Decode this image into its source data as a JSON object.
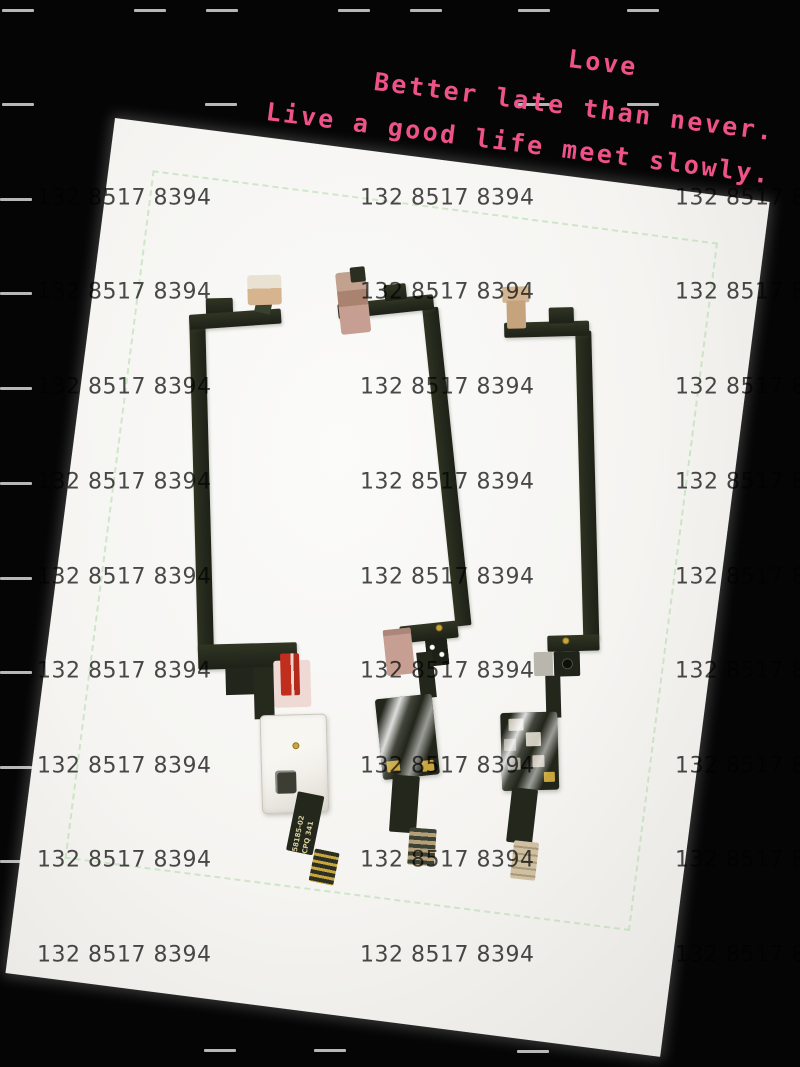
{
  "palette": {
    "background": "#050505",
    "dash": "#cbcbcb",
    "photo_paper": "#f5f4f1",
    "photo_shade": "#e6e5e1",
    "crop_mark_green": "#a8d8a0",
    "watermark_gray": "#3b3b3b",
    "quote_pink": "#ee5288",
    "cable_dark": "#262a1e",
    "connector_tan": "#d6b48e",
    "connector_pink": "#c79e92",
    "pull_tab_red": "#c22e1d",
    "tape_pink": "#eed9d4",
    "shield_white": "#f2f0ea",
    "gold": "#c9a53e",
    "tail_end_tan": "#cfc0a3"
  },
  "background": {
    "dashes": [
      [
        2,
        9
      ],
      [
        134,
        9
      ],
      [
        206,
        9
      ],
      [
        338,
        9
      ],
      [
        410,
        9
      ],
      [
        518,
        9
      ],
      [
        627,
        9
      ],
      [
        2,
        103
      ],
      [
        205,
        103
      ],
      [
        518,
        103
      ],
      [
        627,
        103
      ],
      [
        0,
        198
      ],
      [
        0,
        292
      ],
      [
        0,
        387
      ],
      [
        0,
        482
      ],
      [
        0,
        577
      ],
      [
        0,
        671
      ],
      [
        0,
        766
      ],
      [
        0,
        860
      ],
      [
        204,
        1049
      ],
      [
        314,
        1049
      ],
      [
        517,
        1050
      ],
      [
        627,
        1050
      ]
    ]
  },
  "photo": {
    "x": 115,
    "y": 118,
    "width": 660,
    "height": 862,
    "rotation_deg": 7.3,
    "crop_inset_px": {
      "top": 47,
      "left": 44,
      "right": 46,
      "bottom": 121
    }
  },
  "watermark": {
    "text": "132 8517 8394",
    "columns_x": [
      37,
      360,
      675
    ],
    "rows_y": [
      199,
      293,
      388,
      483,
      578,
      672,
      767,
      861,
      956
    ]
  },
  "quote": {
    "lines": [
      "Love",
      "Better late than never.",
      "Live a good life meet slowly."
    ],
    "rotation_deg": 7.2
  },
  "cables": {
    "left": {
      "tail_markings": [
        "58185-02",
        "CPQ 341"
      ]
    }
  }
}
